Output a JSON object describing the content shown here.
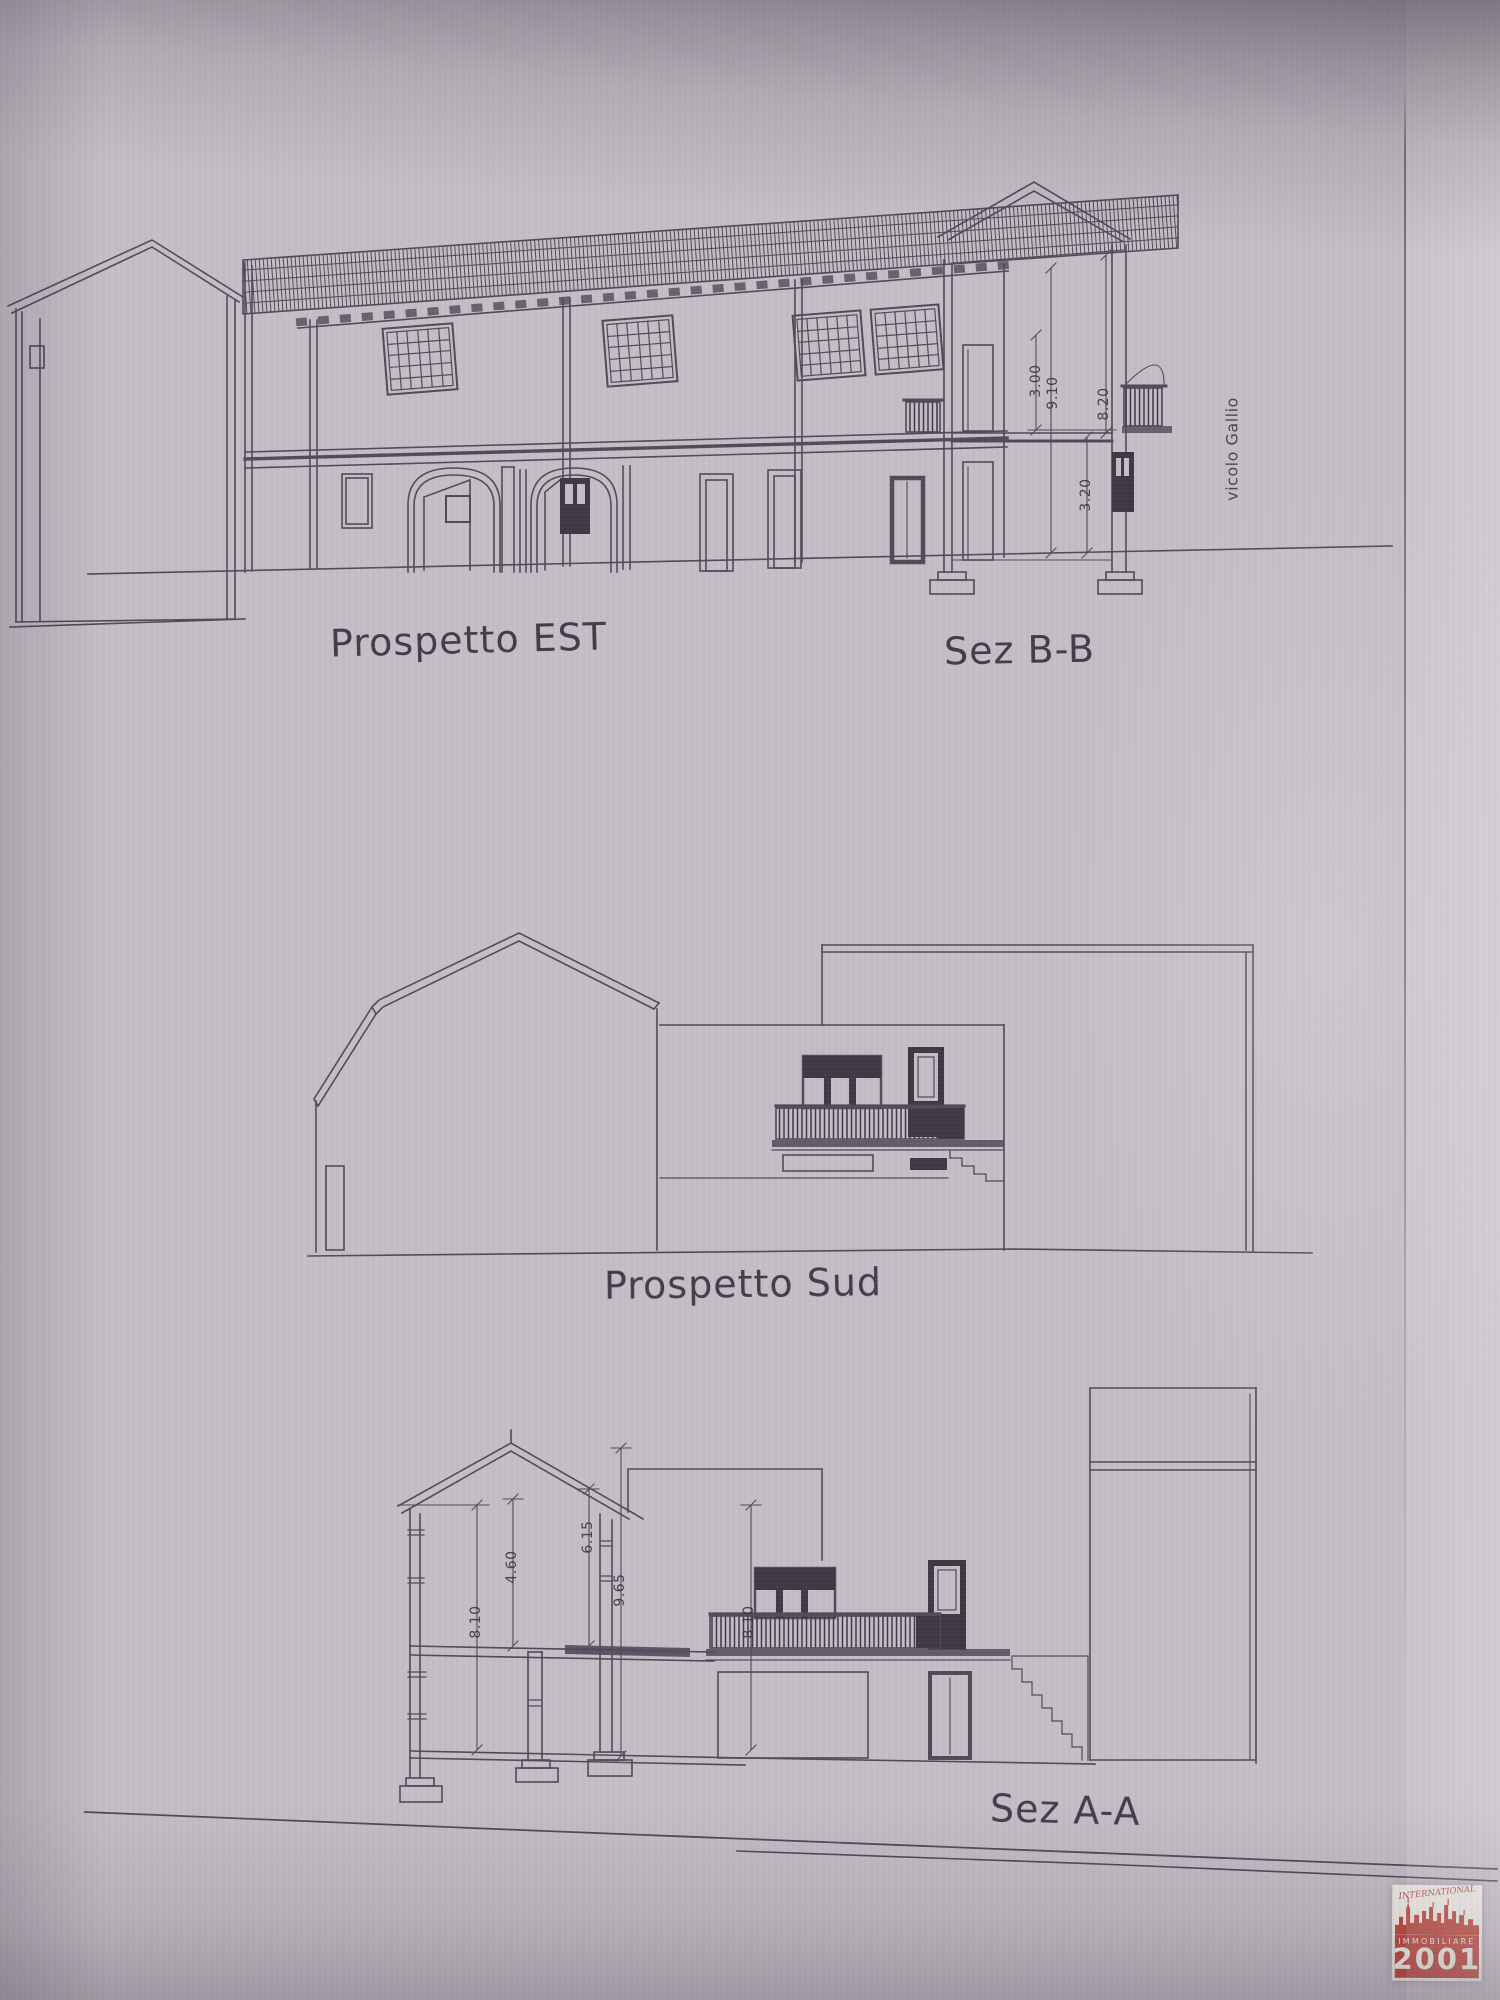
{
  "photo": {
    "paper_color": "#c6bec7",
    "ink_color": "#4a4454"
  },
  "drawings": {
    "top": {
      "label_left": "Prospetto EST",
      "label_right": "Sez B-B",
      "street_label": "vicolo Gallio",
      "dims": {
        "floor_height": "3.00",
        "total_height": "9.10",
        "rear_height": "8.20",
        "ground_floor_height": "3.20"
      }
    },
    "middle": {
      "label": "Prospetto Sud"
    },
    "bottom": {
      "label": "Sez A-A",
      "dims": {
        "left_wall": "8.10",
        "attic": "4.60",
        "ridge_interior": "6.15",
        "overall": "9.65",
        "right_wall": "8.10"
      }
    }
  },
  "logo": {
    "arc_text": "INTERNATIONAL",
    "band_text": "IMMOBILIARE",
    "year_text": "2001",
    "red": "#bf4a40"
  }
}
